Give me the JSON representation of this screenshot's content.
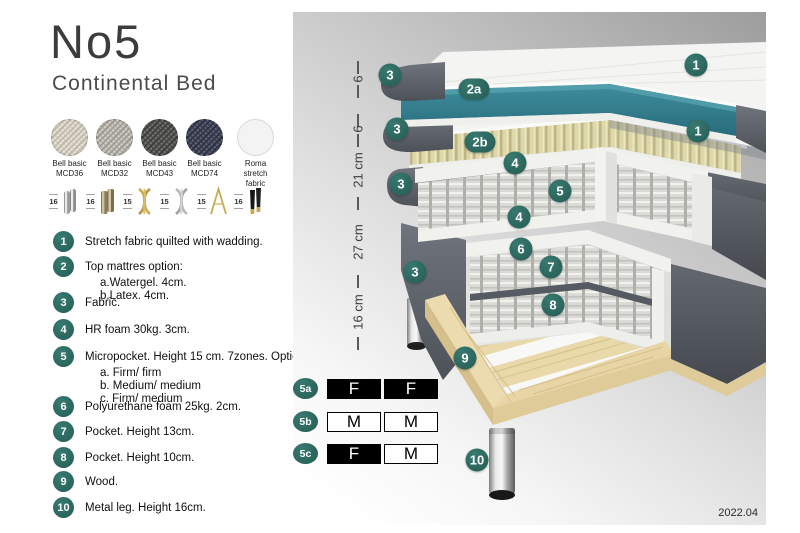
{
  "header": {
    "title": "No5",
    "subtitle": "Continental Bed"
  },
  "fabric_swatches": [
    {
      "line1": "Bell basic",
      "line2": "MCD36"
    },
    {
      "line1": "Bell basic",
      "line2": "MCD32"
    },
    {
      "line1": "Bell basic",
      "line2": "MCD43"
    },
    {
      "line1": "Bell basic",
      "line2": "MCD74"
    },
    {
      "line1": "Roma",
      "line2": "stretch fabric"
    }
  ],
  "leg_options": [
    {
      "height": "16",
      "style": "cylinder-chrome"
    },
    {
      "height": "16",
      "style": "cylinder-bronze"
    },
    {
      "height": "15",
      "style": "twisted-gold"
    },
    {
      "height": "15",
      "style": "twisted-silver"
    },
    {
      "height": "15",
      "style": "hairpin-gold"
    },
    {
      "height": "16",
      "style": "cone-black-gold"
    }
  ],
  "parts": [
    {
      "num": "1",
      "text": "Stretch fabric quilted with wadding."
    },
    {
      "num": "2",
      "text": "Top mattres option:",
      "sub_a": "a.Watergel. 4cm.",
      "sub_b": "b.Latex. 4cm."
    },
    {
      "num": "3",
      "text": "Fabric."
    },
    {
      "num": "4",
      "text": "HR foam 30kg. 3cm."
    },
    {
      "num": "5",
      "text": "Micropocket. Height 15 cm. 7zones. Option:",
      "sub_a": "a. Firm/ firm",
      "sub_b": "b. Medium/ medium",
      "sub_c": "c. Firm/ medium"
    },
    {
      "num": "6",
      "text": "Polyurethane foam 25kg. 2cm."
    },
    {
      "num": "7",
      "text": "Pocket. Height 13cm."
    },
    {
      "num": "8",
      "text": "Pocket. Height 10cm."
    },
    {
      "num": "9",
      "text": "Wood."
    },
    {
      "num": "10",
      "text": "Metal leg. Height 16cm."
    }
  ],
  "diagram": {
    "ruler_labels": [
      "6",
      "6",
      "21 cm",
      "27 cm",
      "16 cm"
    ],
    "badges": [
      "3",
      "2a",
      "1",
      "3",
      "2b",
      "1",
      "4",
      "3",
      "5",
      "4",
      "6",
      "7",
      "3",
      "8",
      "9",
      "10"
    ],
    "firmness_rows": [
      {
        "id": "5a",
        "left": "F",
        "right": "F"
      },
      {
        "id": "5b",
        "left": "M",
        "right": "M"
      },
      {
        "id": "5c",
        "left": "F",
        "right": "M"
      }
    ],
    "version": "2022.04",
    "colors": {
      "accent_badge": "#2d6a62",
      "teal_layer": "#2f7f8f",
      "fabric_grey": "#575c64",
      "wood": "#e6d4a6"
    }
  }
}
